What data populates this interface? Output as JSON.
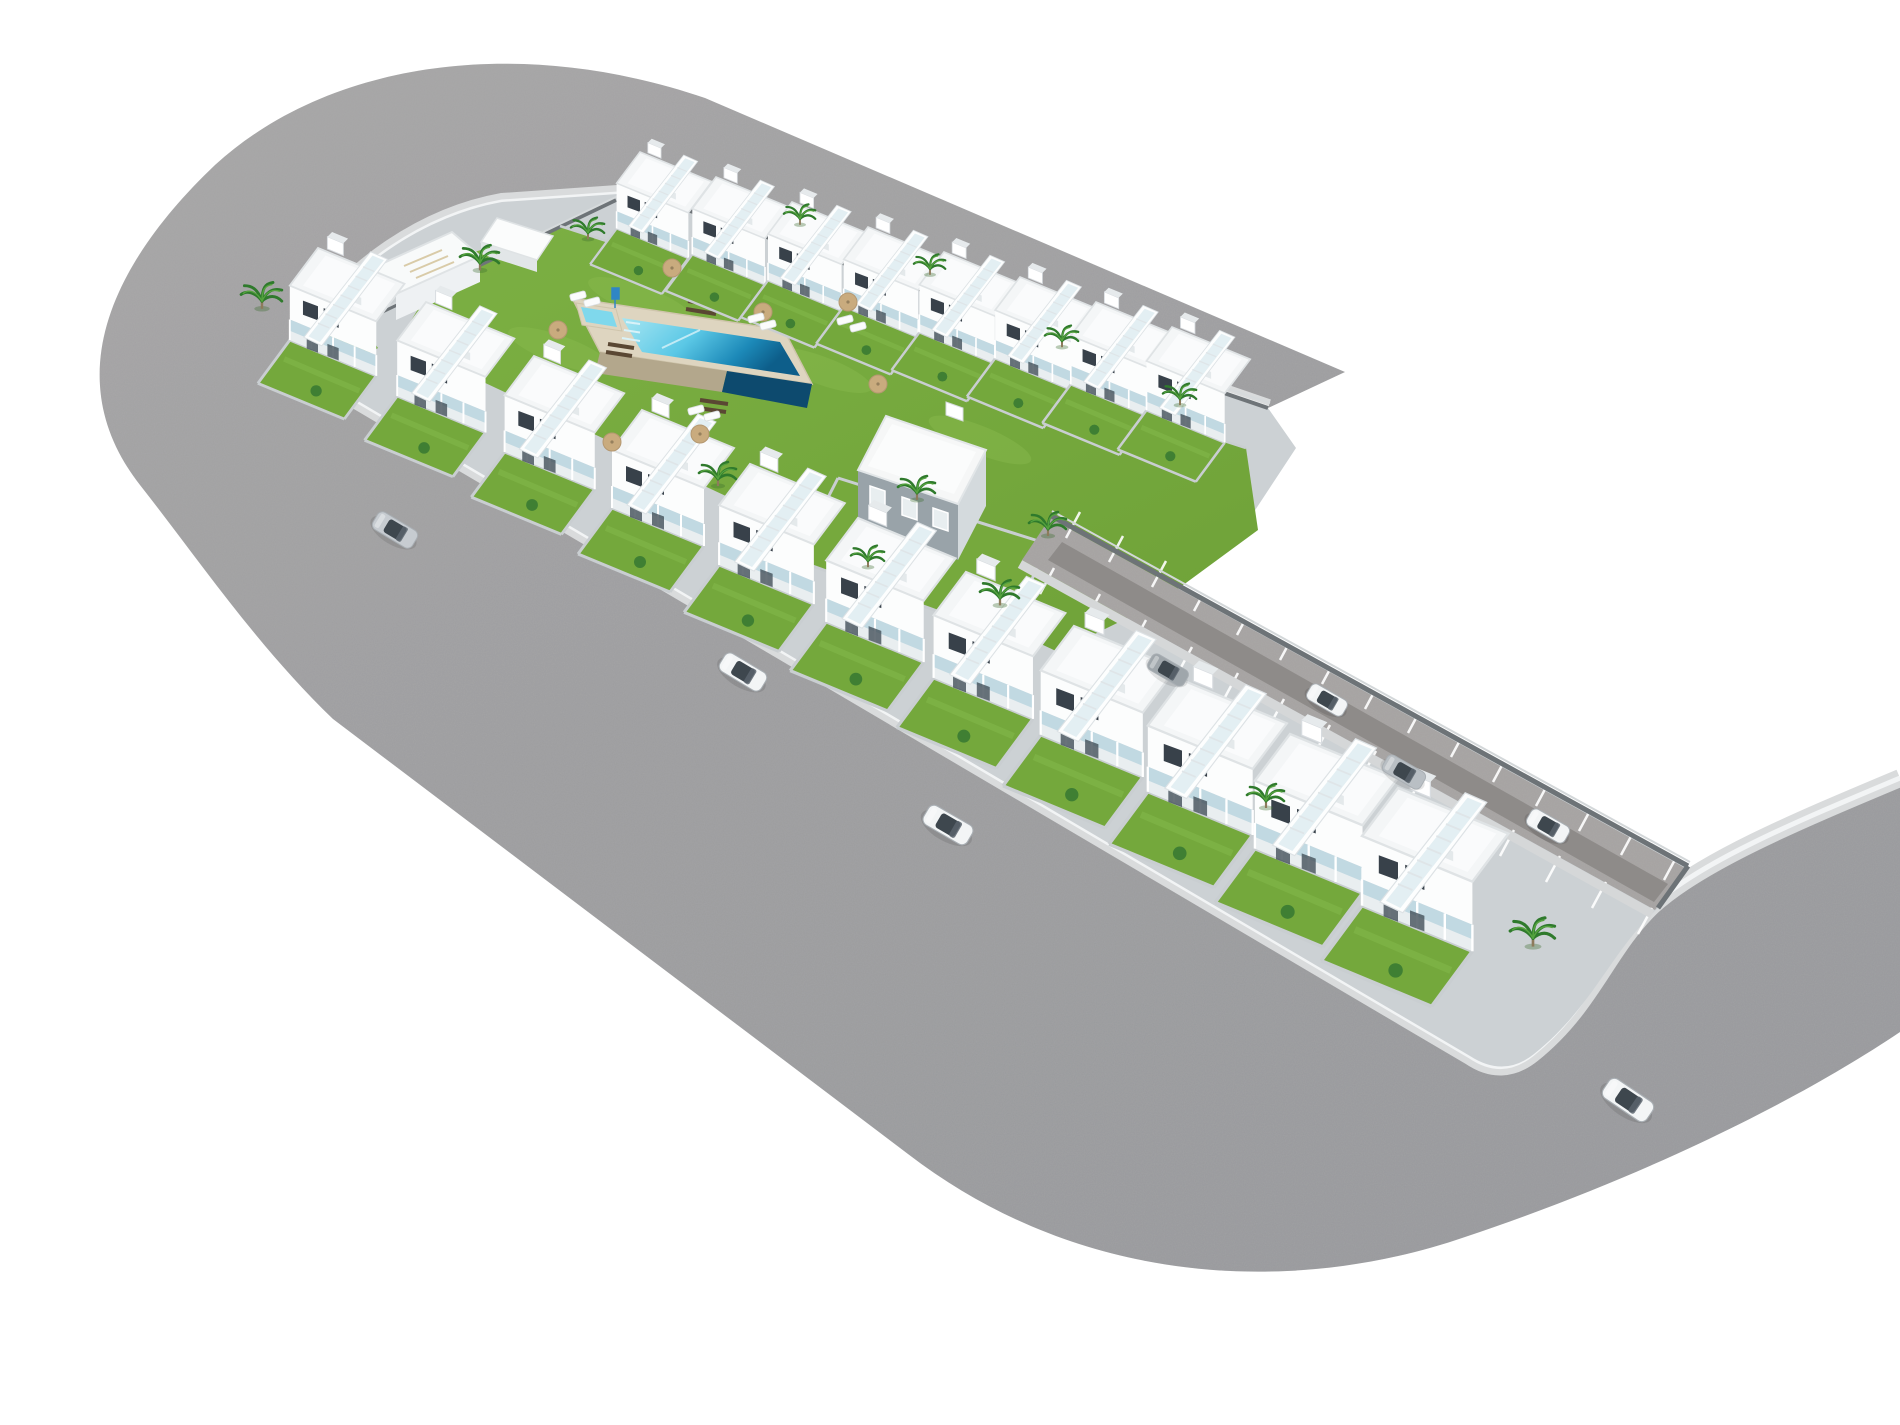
{
  "scene": {
    "kind": "aerial-3d-architectural-render",
    "background": "#ffffff"
  },
  "palette": {
    "road": "#a1a1a3",
    "road_dark": "#98999b",
    "sidewalk": "#d9dbdc",
    "curb": "#f2f4f5",
    "plot_base": "#ccd1d4",
    "lawn": "#76a93c",
    "lawn_light": "#8abb4e",
    "garden": "#74a83c",
    "wall_light": "#c9ced1",
    "wall_dark": "#6e7478",
    "house_white": "#fcfdfd",
    "roof": "#f4f6f7",
    "window": "#38414a",
    "glass": "#bcd6e0",
    "pool_shallow": "#a7e6f2",
    "pool_deep": "#0d5e8a",
    "stone": "#b3a78c",
    "deck": "#5a4733",
    "palm": "#2f7a2c",
    "parasol": "#c9ab7e",
    "car_white": "#f3f5f6",
    "car_silver": "#c7ccd1"
  },
  "geo": {
    "road_d": "M1345,372 L705,98 C520,35 330,60 215,165 C110,265 58,380 140,485 C196,556 256,645 333,719 L908,1154 C1085,1290 1300,1294 1465,1237 C1650,1175 1802,1098 1900,1032 L1900,778 C1795,822 1700,862 1652,906 C1606,950 1592,1006 1532,1054 Q1502,1078 1470,1056 L302,368 Q286,344 310,328 C350,268 424,216 502,202 L632,193 Q652,190 668,202 L1268,408 Z",
    "sidewalk_d": "M1268,408 L668,202 Q652,190 632,193 L502,202 C424,216 350,268 310,328 Q286,344 302,368 L1470,1056 Q1502,1078 1532,1054 C1592,1006 1606,950 1652,906 C1700,862 1795,822 1900,778",
    "plot_d": "M310,328 C350,268 424,216 502,202 L632,193 Q652,190 668,202 L1268,408 L1296,448 L1246,524 L1150,558 L1062,506 L1050,518 L1688,866 L1658,908 C1610,952 1594,1006 1534,1054 Q1504,1078 1470,1056 L302,368 Q286,344 310,328 Z",
    "lawn_d": "M560,226 L1246,448 L1258,530 L1160,602 L1058,652 L398,342 L448,260 Z",
    "lawn_fence_d": "M560,226 L1246,448",
    "nw_wall_d": "M306,348 L616,200",
    "nw_wall_hi_d": "M310,344 L618,196",
    "ne_wall_d": "M664,202 L1268,408",
    "ne_wall_hi_d": "M668,198 L1270,403",
    "hedge_d": "M438,246 L468,256 L468,276 L438,266 Z",
    "corner_garden_d": "M295,348 L350,310 L378,348 L322,382 Z",
    "shed_roof_d": "M497,218 L553,236 L537,260 L481,242 Z",
    "shed_side_d": "M481,242 L537,260 L537,272 L481,254 Z",
    "nwblock_roof_d": "M368,270 L452,232 L480,256 L396,294 Z",
    "nwblock_face_d": "M396,294 L480,256 L480,282 L396,320 Z",
    "nwblock_pergola_d": "M404,266 L442,250 M410,272 L448,256 M416,278 L454,262",
    "pool": {
      "coping_d": "M572,298 L784,330 L812,384 L600,352 Z",
      "water_d": "M622,318 L780,342 L800,376 L642,352 Z",
      "stonewall_d": "M600,352 L727,371 L722,392 L595,373 Z",
      "deepwall_d": "M727,371 L812,384 L807,408 L722,392 Z",
      "steps_d": "M626,322 l14,2 M624,330 l16,2.5 M622,338 l18,3",
      "divider_d": "M700,330 L662,348",
      "kids_coping_d": "M576,303 L616,309 L622,331 L582,325 Z",
      "kids_water_d": "M581,307 L612,312 L617,327 L586,322 Z",
      "sign_d": "M612,288 h7 v11 h-7 Z M615,299 v9"
    },
    "decks_d": "M690,293 l30,5 M688,301 l30,5 M686,309 l30,5 M608,344 l26,4 M606,352 l26,4 M700,400 l28,4 M698,408 l28,4",
    "central": {
      "roof_d": "M886,416 L986,450 L958,504 L858,470 Z",
      "roof_top_d": "M892,424 L976,452 L954,494 L868,466 Z",
      "facade_d": "M858,470 L958,504 L958,560 L858,526 Z",
      "side_d": "M958,504 L986,450 L986,506 L958,560 Z",
      "windows_d": "M870,486 l15,5 v18 l-15,-5 Z M902,497 l15,5 v18 l-15,-5 Z M933,508 l15,5 v18 l-15,-5 Z",
      "chimney_d": "M946,402 L963,408 L963,421 L946,415 Z",
      "garden_d": "M838,478 L1048,544 L1006,636 L796,560 Z",
      "garden_walls_d": "M838,478 L1048,544 M796,560 L1006,636 M838,478 L796,560 M1048,544 L1006,636"
    },
    "strip": {
      "base_d": "M1050,518 L1685,868 L1655,910 L1022,560 Z",
      "lane_d": "M1062,542 L1668,884 L1654,902 L1048,560 Z",
      "wall_d": "M1050,515 L1688,866",
      "wall_hi_d": "M1052,511 L1690,862",
      "endwall_d": "M1688,866 L1658,908",
      "walk_d": "M1020,564 L1652,914",
      "bays_ne_d": "M1066,538 l14,-26 M1109,562 l14,-26 M1152,587 l14,-26 M1194,611 l14,-26 M1237,635 l14,-26 M1280,660 l14,-26 M1322,684 l14,-26 M1365,709 l14,-26 M1408,733 l14,-26 M1451,757 l14,-26 M1493,782 l14,-26 M1536,806 l14,-26 M1579,831 l14,-26 M1621,855 l14,-26 M1664,880 l14,-26",
      "bays_sw_d": "M1054,568 l-14,26 M1100,594 l-14,26 M1146,620 l-14,26 M1192,647 l-14,26 M1238,673 l-14,26 M1284,699 l-14,26 M1330,725 l-14,26 M1376,751 l-14,26 M1422,777 l-14,26 M1468,803 l-14,26 M1514,830 l-14,26 M1560,856 l-14,26 M1606,882 l-14,26 M1652,908 l-14,26"
    }
  },
  "rows": {
    "left": {
      "units": [
        {
          "attrs": {
            "transform": "translate(318,248) scale(0.94)"
          }
        },
        {
          "attrs": {
            "transform": "translate(426,302) scale(0.96)"
          }
        },
        {
          "attrs": {
            "transform": "translate(534,356) scale(0.98)"
          }
        },
        {
          "attrs": {
            "transform": "translate(642,410) scale(1.00)"
          }
        },
        {
          "attrs": {
            "transform": "translate(750,464) scale(1.03)"
          }
        },
        {
          "attrs": {
            "transform": "translate(858,518) scale(1.06)"
          }
        },
        {
          "attrs": {
            "transform": "translate(966,572) scale(1.08)"
          }
        },
        {
          "attrs": {
            "transform": "translate(1074,626) scale(1.11)"
          }
        },
        {
          "attrs": {
            "transform": "translate(1182,680) scale(1.14)"
          }
        },
        {
          "attrs": {
            "transform": "translate(1290,734) scale(1.17)"
          }
        },
        {
          "attrs": {
            "transform": "translate(1398,788) scale(1.20)"
          }
        }
      ]
    },
    "top": {
      "units": [
        {
          "attrs": {
            "transform": "translate(640,152) scale(0.78)"
          }
        },
        {
          "attrs": {
            "transform": "translate(716,177) scale(0.79)"
          }
        },
        {
          "attrs": {
            "transform": "translate(792,202) scale(0.80)"
          }
        },
        {
          "attrs": {
            "transform": "translate(868,227) scale(0.81)"
          }
        },
        {
          "attrs": {
            "transform": "translate(944,252) scale(0.82)"
          }
        },
        {
          "attrs": {
            "transform": "translate(1020,277) scale(0.83)"
          }
        },
        {
          "attrs": {
            "transform": "translate(1096,302) scale(0.84)"
          }
        },
        {
          "attrs": {
            "transform": "translate(1172,327) scale(0.85)"
          }
        }
      ]
    }
  },
  "features": {
    "palms": [
      {
        "attrs": {
          "transform": "translate(262,300) scale(1.1)"
        }
      },
      {
        "attrs": {
          "transform": "translate(480,262) scale(1.05)"
        }
      },
      {
        "attrs": {
          "transform": "translate(588,232) scale(0.9)"
        }
      },
      {
        "attrs": {
          "transform": "translate(800,218) scale(0.85)"
        }
      },
      {
        "attrs": {
          "transform": "translate(930,268) scale(0.85)"
        }
      },
      {
        "attrs": {
          "transform": "translate(1062,340) scale(0.9)"
        }
      },
      {
        "attrs": {
          "transform": "translate(1180,398) scale(0.9)"
        }
      },
      {
        "attrs": {
          "transform": "translate(718,478) scale(1.0)"
        }
      },
      {
        "attrs": {
          "transform": "translate(917,492) scale(1.0)"
        }
      },
      {
        "attrs": {
          "transform": "translate(1048,528) scale(1.0)"
        }
      },
      {
        "attrs": {
          "transform": "translate(1000,597) scale(1.05)"
        }
      },
      {
        "attrs": {
          "transform": "translate(1533,937) scale(1.2)"
        }
      },
      {
        "attrs": {
          "transform": "translate(1266,800) scale(1.0)"
        }
      },
      {
        "attrs": {
          "transform": "translate(868,560) scale(0.9)"
        }
      }
    ],
    "parasols": [
      {
        "attrs": {
          "transform": "translate(672,268)"
        }
      },
      {
        "attrs": {
          "transform": "translate(763,312)"
        }
      },
      {
        "attrs": {
          "transform": "translate(848,302)"
        }
      },
      {
        "attrs": {
          "transform": "translate(878,384)"
        }
      },
      {
        "attrs": {
          "transform": "translate(700,434)"
        }
      },
      {
        "attrs": {
          "transform": "translate(612,442)"
        }
      },
      {
        "attrs": {
          "transform": "translate(558,330)"
        }
      }
    ],
    "loungers": [
      {
        "attrs": {
          "transform": "translate(578,296) rotate(-15)"
        }
      },
      {
        "attrs": {
          "transform": "translate(592,302) rotate(-15)"
        }
      },
      {
        "attrs": {
          "transform": "translate(756,318) rotate(-15)"
        }
      },
      {
        "attrs": {
          "transform": "translate(768,325) rotate(-15)"
        }
      },
      {
        "attrs": {
          "transform": "translate(712,416) rotate(-15)"
        }
      },
      {
        "attrs": {
          "transform": "translate(696,410) rotate(-15)"
        }
      },
      {
        "attrs": {
          "transform": "translate(845,320) rotate(-15)"
        }
      },
      {
        "attrs": {
          "transform": "translate(858,327) rotate(-15)"
        }
      }
    ],
    "patches": [
      {
        "attrs": {
          "transform": "translate(640,300) rotate(20)"
        }
      },
      {
        "attrs": {
          "transform": "translate(820,370) rotate(20)"
        }
      },
      {
        "attrs": {
          "transform": "translate(980,440) rotate(22)"
        }
      },
      {
        "attrs": {
          "transform": "translate(560,350) rotate(20)"
        }
      }
    ]
  },
  "cars": [
    {
      "attrs": {
        "transform": "translate(395,530) rotate(31)",
        "color": "#c7ccd1"
      }
    },
    {
      "attrs": {
        "transform": "translate(743,672) rotate(31) scale(1.05)",
        "color": "#f3f5f6"
      }
    },
    {
      "attrs": {
        "transform": "translate(948,825) rotate(30) scale(1.1)",
        "color": "#f3f5f6"
      }
    },
    {
      "attrs": {
        "transform": "translate(1628,1100) rotate(34) scale(1.15)",
        "color": "#f3f5f6"
      }
    },
    {
      "attrs": {
        "transform": "translate(1168,670) rotate(30) scale(0.9)",
        "color": "#9fa6ab"
      }
    },
    {
      "attrs": {
        "transform": "translate(1327,700) rotate(30) scale(0.9)",
        "color": "#f3f5f6"
      }
    },
    {
      "attrs": {
        "transform": "translate(1404,772) rotate(30) scale(0.95)",
        "color": "#b9bfc4"
      }
    },
    {
      "attrs": {
        "transform": "translate(1548,826) rotate(30) scale(0.95)",
        "color": "#f3f5f6"
      }
    }
  ]
}
